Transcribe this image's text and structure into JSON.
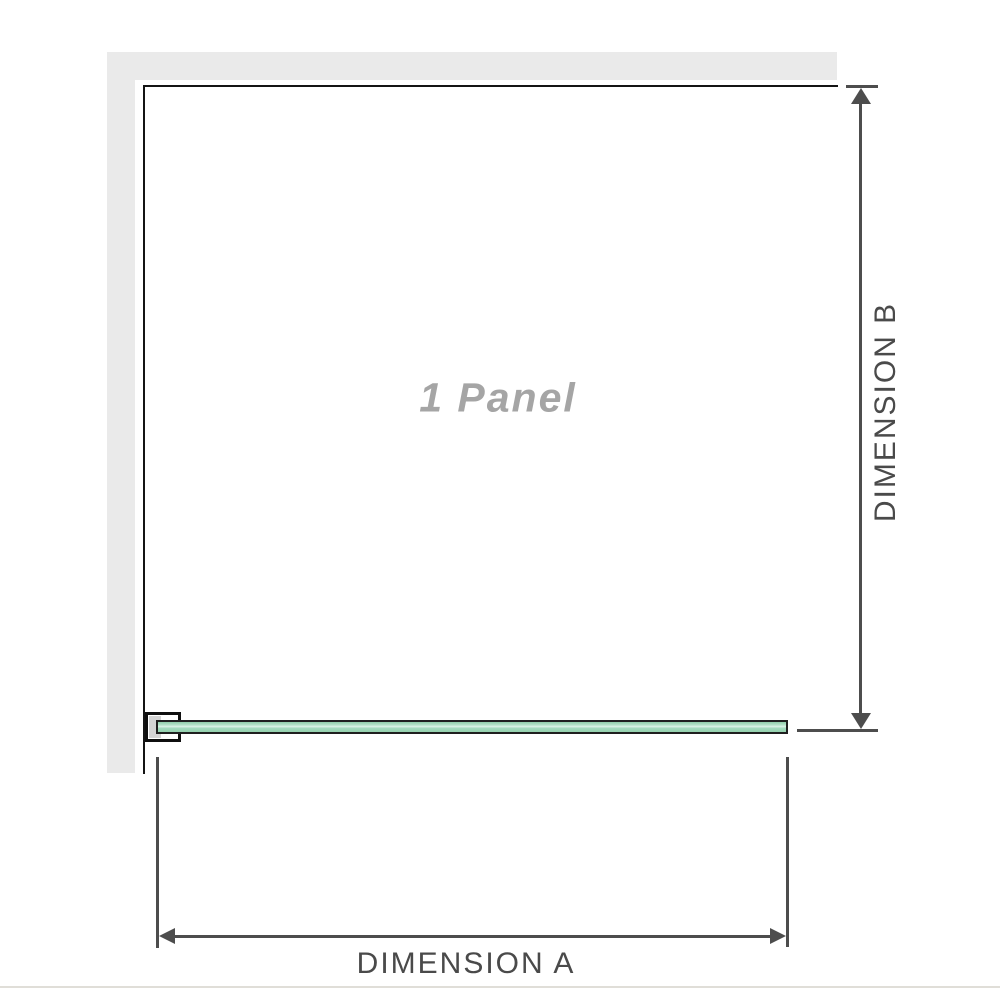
{
  "diagram": {
    "panel_label": "1 Panel",
    "dimensions": {
      "a_label": "DIMENSION A",
      "b_label": "DIMENSION B"
    }
  },
  "colors": {
    "wall": "#eaeaea",
    "outline": "#141414",
    "dimension_line": "#4d4d4d",
    "dimension_text": "#4a4a4a",
    "panel_text": "#a5a5a5",
    "glass_green": "#a4dbbe",
    "glass_border": "#1f1f1f",
    "bracket_pad": "#d4d4d4",
    "divider": "#e0ded8"
  }
}
